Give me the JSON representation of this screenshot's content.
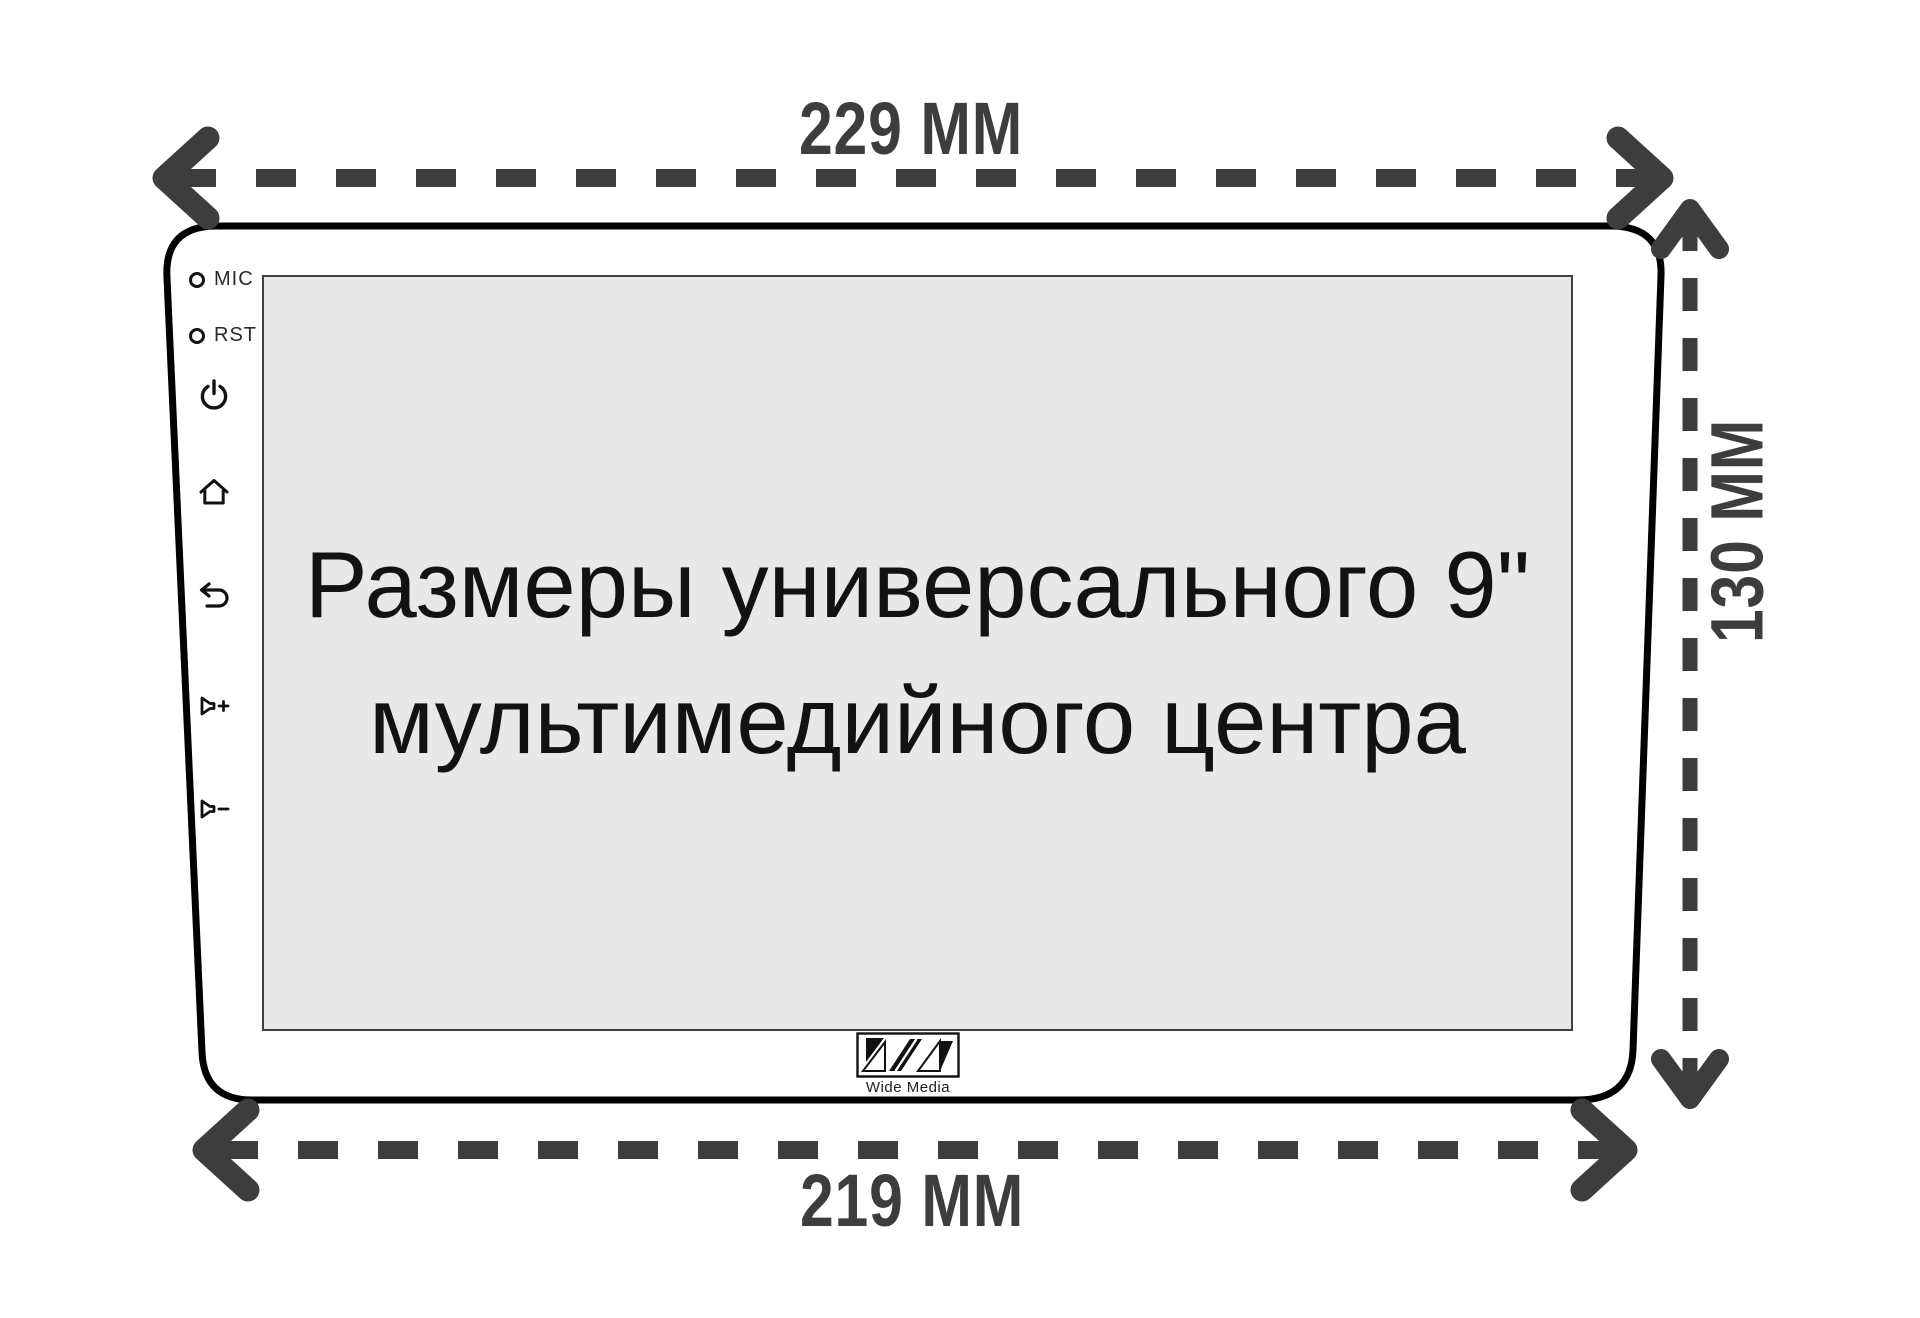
{
  "diagram": {
    "subject": "universal 9-inch multimedia head unit dimensions",
    "dimensions": {
      "width_top": "229 MM",
      "width_bottom": "219 MM",
      "height_right": "130 MM"
    },
    "screen_text": {
      "line1": "Размеры универсального 9\"",
      "line2": "мультимедийного центра"
    },
    "side_controls": {
      "mic_label": "MIC",
      "rst_label": "RST",
      "icons": [
        "power-icon",
        "home-icon",
        "back-icon",
        "volume-up-icon",
        "volume-down-icon"
      ]
    },
    "brand": {
      "name": "Wide Media",
      "logo": "WM diagonal monogram"
    },
    "colors": {
      "arrow": "#3d3d3d",
      "body_outline": "#000000",
      "screen_background": "#e8e8e8",
      "screen_border": "#3f3f3f",
      "label_text": "#3d3d3d",
      "background": "#ffffff"
    }
  }
}
